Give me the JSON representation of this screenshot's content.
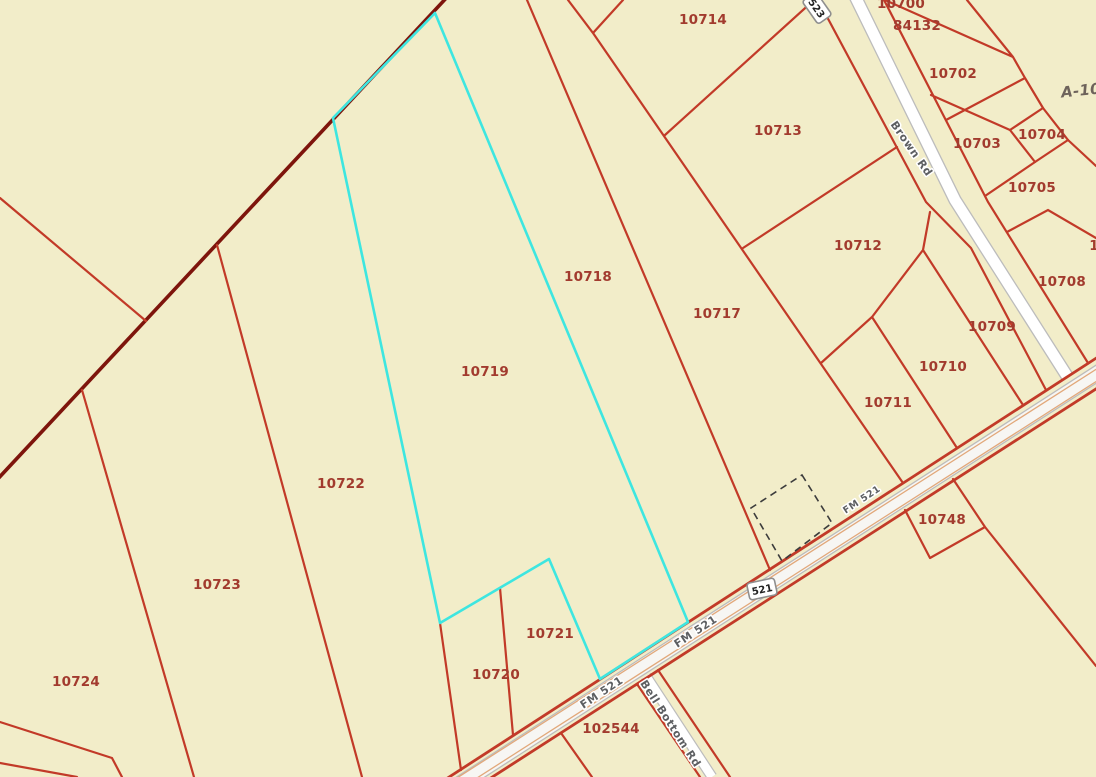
{
  "map": {
    "highlighted_parcel": "10719",
    "colors": {
      "background": "#f2edc9",
      "parcel_line": "#c23a28",
      "boundary_dark": "#7e150c",
      "parcel_label": "#a23b2e",
      "highlight": "#3ee6e0",
      "road_fill": "#ffffff",
      "road_casing": "#bcbcbc",
      "fm_fill": "#f7f6f3",
      "lane_line": "#e2a87a",
      "road_label": "#5d5f62",
      "dashed_line": "#3c3c3c",
      "shield_fill": "#ffffff",
      "shield_border": "#8f8f8f",
      "shield_text": "#222222",
      "survey_label": "#6e635b"
    },
    "parcel_labels": [
      {
        "text": "10700",
        "x": 901,
        "y": 4
      },
      {
        "text": "84132",
        "x": 917,
        "y": 26
      },
      {
        "text": "10702",
        "x": 953,
        "y": 74
      },
      {
        "text": "10703",
        "x": 977,
        "y": 144
      },
      {
        "text": "10704",
        "x": 1042,
        "y": 135
      },
      {
        "text": "10705",
        "x": 1032,
        "y": 188
      },
      {
        "text": "10708",
        "x": 1062,
        "y": 282
      },
      {
        "text": "10709",
        "x": 992,
        "y": 327
      },
      {
        "text": "10710",
        "x": 943,
        "y": 367
      },
      {
        "text": "10711",
        "x": 888,
        "y": 403
      },
      {
        "text": "10712",
        "x": 858,
        "y": 246
      },
      {
        "text": "10713",
        "x": 778,
        "y": 131
      },
      {
        "text": "10714",
        "x": 703,
        "y": 20
      },
      {
        "text": "10717",
        "x": 717,
        "y": 314
      },
      {
        "text": "10718",
        "x": 588,
        "y": 277
      },
      {
        "text": "10719",
        "x": 485,
        "y": 372
      },
      {
        "text": "10720",
        "x": 496,
        "y": 675
      },
      {
        "text": "10721",
        "x": 550,
        "y": 634
      },
      {
        "text": "10722",
        "x": 341,
        "y": 484
      },
      {
        "text": "10723",
        "x": 217,
        "y": 585
      },
      {
        "text": "10724",
        "x": 76,
        "y": 682
      },
      {
        "text": "10748",
        "x": 942,
        "y": 520
      },
      {
        "text": "102544",
        "x": 611,
        "y": 729
      },
      {
        "text": "1",
        "x": 1094,
        "y": 246
      }
    ],
    "road_labels": [
      {
        "text": "Brown Rd",
        "x": 911,
        "y": 149,
        "angle": 55,
        "size": 11
      },
      {
        "text": "FM 521",
        "x": 696,
        "y": 632,
        "angle": -33.5,
        "size": 11
      },
      {
        "text": "FM 521",
        "x": 602,
        "y": 693,
        "angle": -33.5,
        "size": 11
      },
      {
        "text": "FM 521",
        "x": 862,
        "y": 500,
        "angle": -33.5,
        "size": 9.5
      },
      {
        "text": "Bell Bottom Rd",
        "x": 670,
        "y": 724,
        "angle": 57,
        "size": 11
      }
    ],
    "route_shields": [
      {
        "text": "521",
        "x": 762,
        "y": 589,
        "angle": -12
      },
      {
        "text": "523",
        "x": 817,
        "y": 8,
        "angle": 55
      }
    ],
    "survey_label": {
      "text": "A-10",
      "x": 1081,
      "y": 91,
      "angle": -6
    }
  }
}
